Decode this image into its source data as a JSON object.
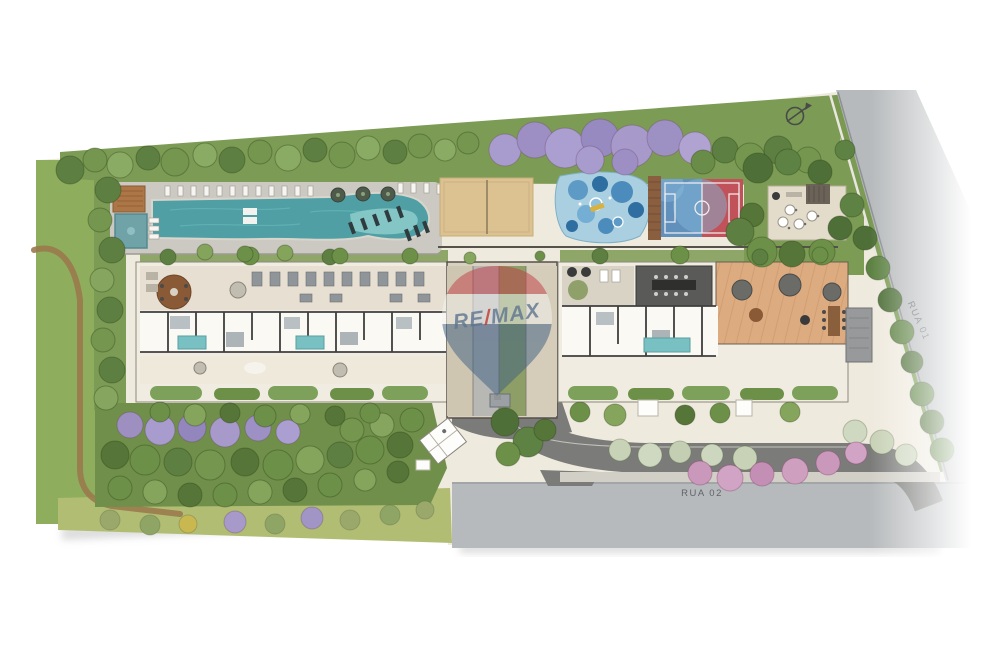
{
  "streets": {
    "rua01": "RUA 01",
    "rua02": "RUA 02"
  },
  "watermark": {
    "re": "RE",
    "slash": "/",
    "max": "MAX",
    "full": "RE/MAX"
  },
  "icons": {
    "north_arrow": "north-arrow"
  },
  "colors": {
    "pool_water": "#4f9fa4",
    "pool_shelf": "#8ccccb",
    "lawn": "#8fae5d",
    "bottom_lawn": "#b2bd74",
    "tree_green": "#5d7f42",
    "tree_purple": "#a79aca",
    "tree_pink": "#cf9fc0",
    "sand_court": "#dcc191",
    "court_blue": "#6290bc",
    "court_red": "#c2525a",
    "street_gray": "#b7babc",
    "drive_asphalt": "#7b7c7a",
    "building_floor": "#f1ece1",
    "terrace_wood": "#dcab80",
    "core_green_stripe": "#8d9e66",
    "balloon_red": "#c23a44",
    "balloon_blue": "#3c5d82",
    "remax_letters": "#5f7590",
    "dirt_path": "#9a7a4c"
  }
}
